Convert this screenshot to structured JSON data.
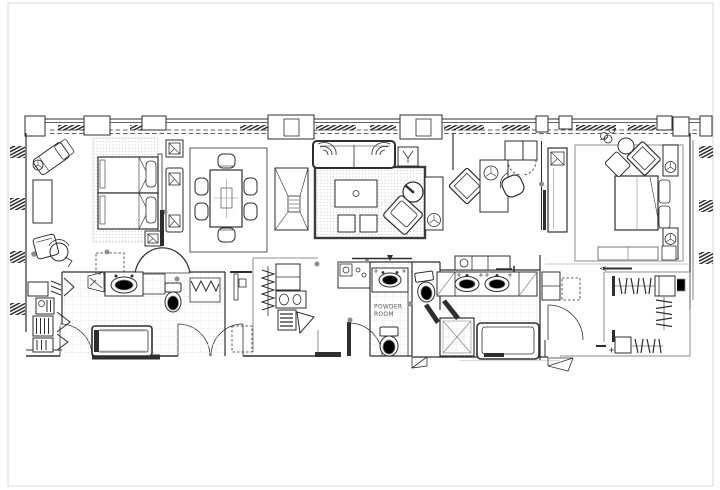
{
  "colors": {
    "paper": "#ffffff",
    "ink": "#2e2e2e",
    "mid": "#8c8c8c",
    "soft": "#b5b5b5",
    "rug": "#b9b9b9",
    "tile": "#e3e3e3",
    "frame": "#d9d9d9"
  },
  "labels": {
    "powder_room": [
      "POWDER",
      "ROOM"
    ]
  }
}
